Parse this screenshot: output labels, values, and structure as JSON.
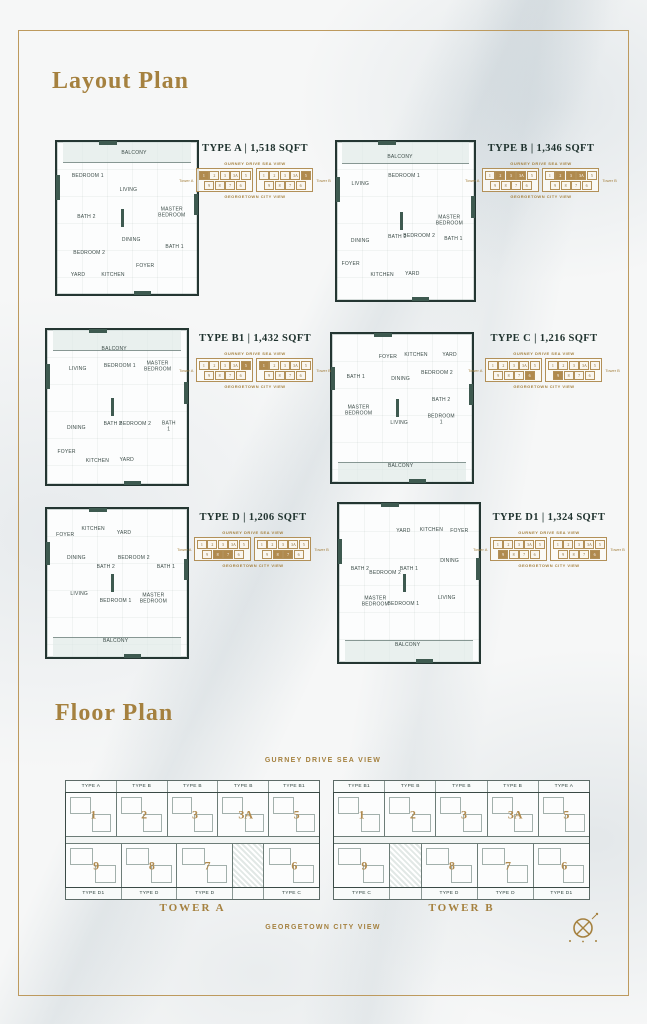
{
  "page": {
    "layout_plan_title": "Layout Plan",
    "floor_plan_title": "Floor Plan",
    "sea_view_label": "GURNEY DRIVE SEA VIEW",
    "city_view_label": "GEORGETOWN CITY VIEW"
  },
  "colors": {
    "gold_accent": "#A5813F",
    "heading_dark": "#20332F",
    "plan_wall": "#243632",
    "plan_teal": "#3E5A50",
    "locator_highlight": "#B08A4E"
  },
  "locator": {
    "sea_label": "GURNEY DRIVE SEA VIEW",
    "city_label": "GEORGETOWN CITY VIEW",
    "tower_a_label": "Tower A",
    "tower_b_label": "Tower B",
    "top_cells": [
      "1",
      "2",
      "3",
      "3A",
      "5"
    ],
    "bottom_cells": [
      "9",
      "8",
      "7",
      "6"
    ]
  },
  "units": [
    {
      "type": "TYPE A",
      "title": "TYPE A | 1,518 SQFT",
      "balcony": "top",
      "highlight_tower_a": [
        "1"
      ],
      "highlight_tower_b": [
        "5"
      ],
      "rooms": [
        {
          "label": "BALCONY",
          "x": 55,
          "y": 8
        },
        {
          "label": "BEDROOM 1",
          "x": 22,
          "y": 23
        },
        {
          "label": "LIVING",
          "x": 51,
          "y": 32
        },
        {
          "label": "MASTER BEDROOM",
          "x": 82,
          "y": 47
        },
        {
          "label": "BATH 2",
          "x": 21,
          "y": 50
        },
        {
          "label": "DINING",
          "x": 53,
          "y": 65
        },
        {
          "label": "BEDROOM 2",
          "x": 23,
          "y": 74
        },
        {
          "label": "BATH 1",
          "x": 84,
          "y": 70
        },
        {
          "label": "YARD",
          "x": 15,
          "y": 88
        },
        {
          "label": "KITCHEN",
          "x": 40,
          "y": 88
        },
        {
          "label": "FOYER",
          "x": 63,
          "y": 82
        }
      ]
    },
    {
      "type": "TYPE B",
      "title": "TYPE B | 1,346 SQFT",
      "balcony": "top",
      "highlight_tower_a": [
        "2",
        "3",
        "3A"
      ],
      "highlight_tower_b": [
        "2",
        "3",
        "3A"
      ],
      "rooms": [
        {
          "label": "BALCONY",
          "x": 46,
          "y": 10
        },
        {
          "label": "LIVING",
          "x": 17,
          "y": 27
        },
        {
          "label": "BEDROOM 1",
          "x": 49,
          "y": 22
        },
        {
          "label": "MASTER BEDROOM",
          "x": 82,
          "y": 50
        },
        {
          "label": "DINING",
          "x": 17,
          "y": 63
        },
        {
          "label": "BATH 2",
          "x": 44,
          "y": 61
        },
        {
          "label": "BEDROOM 2",
          "x": 60,
          "y": 60
        },
        {
          "label": "BATH 1",
          "x": 85,
          "y": 62
        },
        {
          "label": "FOYER",
          "x": 10,
          "y": 78
        },
        {
          "label": "KITCHEN",
          "x": 33,
          "y": 85
        },
        {
          "label": "YARD",
          "x": 55,
          "y": 84
        }
      ]
    },
    {
      "type": "TYPE B1",
      "title": "TYPE B1 | 1,432 SQFT",
      "balcony": "top",
      "highlight_tower_a": [
        "5"
      ],
      "highlight_tower_b": [
        "1"
      ],
      "rooms": [
        {
          "label": "BALCONY",
          "x": 48,
          "y": 13
        },
        {
          "label": "LIVING",
          "x": 22,
          "y": 26
        },
        {
          "label": "BEDROOM 1",
          "x": 52,
          "y": 24
        },
        {
          "label": "MASTER BEDROOM",
          "x": 79,
          "y": 24
        },
        {
          "label": "DINING",
          "x": 21,
          "y": 64
        },
        {
          "label": "BATH 2",
          "x": 47,
          "y": 62
        },
        {
          "label": "BEDROOM 2",
          "x": 63,
          "y": 62
        },
        {
          "label": "BATH 1",
          "x": 87,
          "y": 63
        },
        {
          "label": "FOYER",
          "x": 14,
          "y": 80
        },
        {
          "label": "KITCHEN",
          "x": 36,
          "y": 86
        },
        {
          "label": "YARD",
          "x": 57,
          "y": 85
        }
      ]
    },
    {
      "type": "TYPE C",
      "title": "TYPE C | 1,216 SQFT",
      "balcony": "bottom",
      "highlight_tower_a": [
        "6"
      ],
      "highlight_tower_b": [
        "9"
      ],
      "rooms": [
        {
          "label": "FOYER",
          "x": 40,
          "y": 16
        },
        {
          "label": "KITCHEN",
          "x": 60,
          "y": 15
        },
        {
          "label": "YARD",
          "x": 84,
          "y": 15
        },
        {
          "label": "BATH 1",
          "x": 17,
          "y": 30
        },
        {
          "label": "DINING",
          "x": 49,
          "y": 31
        },
        {
          "label": "BEDROOM 2",
          "x": 75,
          "y": 27
        },
        {
          "label": "MASTER BEDROOM",
          "x": 19,
          "y": 52
        },
        {
          "label": "BATH 2",
          "x": 78,
          "y": 45
        },
        {
          "label": "LIVING",
          "x": 48,
          "y": 61
        },
        {
          "label": "BEDROOM 1",
          "x": 78,
          "y": 58
        },
        {
          "label": "BALCONY",
          "x": 49,
          "y": 90
        }
      ]
    },
    {
      "type": "TYPE D",
      "title": "TYPE D | 1,206 SQFT",
      "balcony": "bottom",
      "highlight_tower_a": [
        "8",
        "7"
      ],
      "highlight_tower_b": [
        "8",
        "7"
      ],
      "rooms": [
        {
          "label": "FOYER",
          "x": 13,
          "y": 18
        },
        {
          "label": "KITCHEN",
          "x": 33,
          "y": 14
        },
        {
          "label": "YARD",
          "x": 55,
          "y": 17
        },
        {
          "label": "DINING",
          "x": 21,
          "y": 34
        },
        {
          "label": "BATH 2",
          "x": 42,
          "y": 40
        },
        {
          "label": "BEDROOM 2",
          "x": 62,
          "y": 34
        },
        {
          "label": "BATH 1",
          "x": 85,
          "y": 40
        },
        {
          "label": "LIVING",
          "x": 23,
          "y": 58
        },
        {
          "label": "BEDROOM 1",
          "x": 49,
          "y": 63
        },
        {
          "label": "MASTER BEDROOM",
          "x": 76,
          "y": 61
        },
        {
          "label": "BALCONY",
          "x": 49,
          "y": 90
        }
      ]
    },
    {
      "type": "TYPE D1",
      "title": "TYPE D1 | 1,324 SQFT",
      "balcony": "bottom",
      "highlight_tower_a": [
        "9"
      ],
      "highlight_tower_b": [
        "6"
      ],
      "rooms": [
        {
          "label": "YARD",
          "x": 46,
          "y": 18
        },
        {
          "label": "KITCHEN",
          "x": 66,
          "y": 17
        },
        {
          "label": "FOYER",
          "x": 86,
          "y": 18
        },
        {
          "label": "BATH 2",
          "x": 15,
          "y": 42
        },
        {
          "label": "BEDROOM 2",
          "x": 33,
          "y": 44
        },
        {
          "label": "BATH 1",
          "x": 50,
          "y": 42
        },
        {
          "label": "DINING",
          "x": 79,
          "y": 37
        },
        {
          "label": "MASTER BEDROOM",
          "x": 26,
          "y": 62
        },
        {
          "label": "BEDROOM 1",
          "x": 46,
          "y": 64
        },
        {
          "label": "LIVING",
          "x": 77,
          "y": 60
        },
        {
          "label": "BALCONY",
          "x": 49,
          "y": 90
        }
      ]
    }
  ],
  "towers": [
    {
      "name": "TOWER A",
      "top_types": [
        "TYPE A",
        "TYPE B",
        "TYPE B",
        "TYPE B",
        "TYPE B1"
      ],
      "top_units": [
        "1",
        "2",
        "3",
        "3A",
        "5"
      ],
      "bottom_cells": [
        "9",
        "8",
        "7",
        "CORE",
        "6"
      ],
      "bottom_types": [
        "TYPE D1",
        "TYPE D",
        "TYPE D",
        "",
        "TYPE C"
      ]
    },
    {
      "name": "TOWER B",
      "top_types": [
        "TYPE B1",
        "TYPE B",
        "TYPE B",
        "TYPE B",
        "TYPE A"
      ],
      "top_units": [
        "1",
        "2",
        "3",
        "3A",
        "5"
      ],
      "bottom_cells": [
        "9",
        "CORE",
        "8",
        "7",
        "6"
      ],
      "bottom_types": [
        "TYPE C",
        "",
        "TYPE D",
        "TYPE D",
        "TYPE D1"
      ]
    }
  ]
}
